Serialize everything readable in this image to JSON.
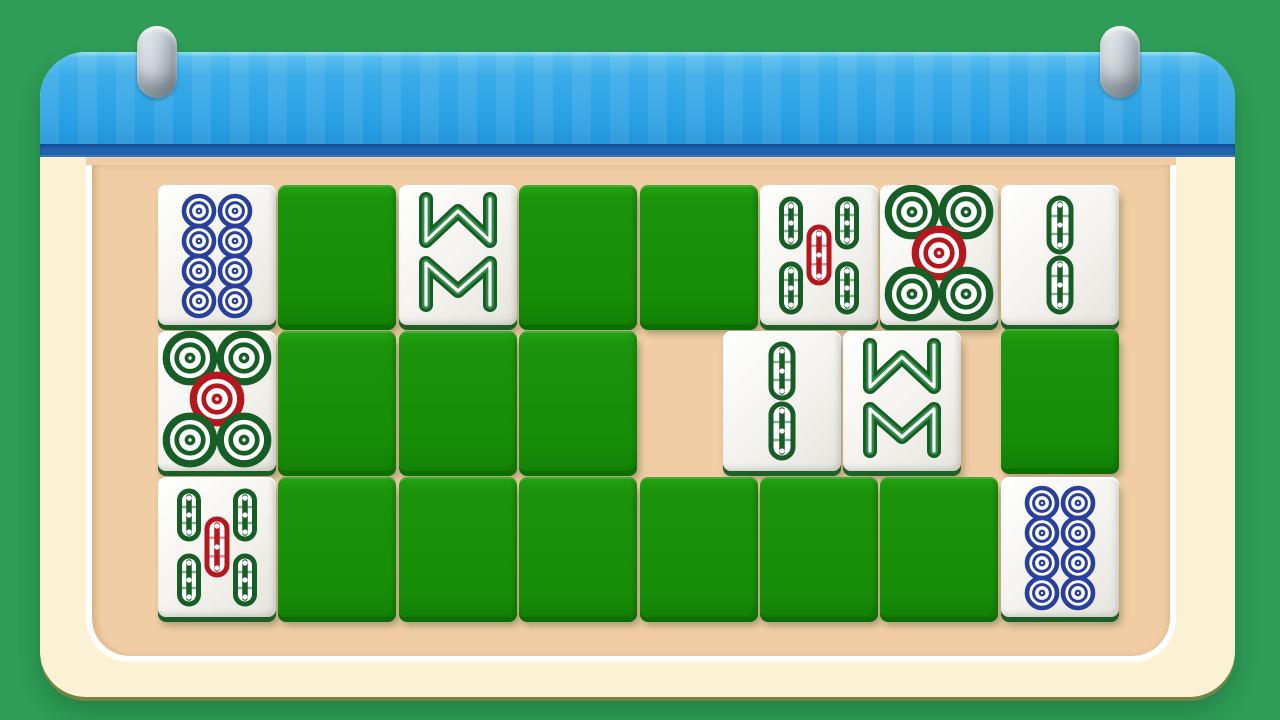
{
  "app": {
    "type": "mahjong-memory-matching-game",
    "scene": "hanging calendar-style board on green table"
  },
  "colors": {
    "background": "#2f9c57",
    "panel": "#fbf2d6",
    "topbar": "#32a5e6",
    "topbar_edge": "#1e62b0",
    "felt": "#f0cda4",
    "tile_down": "#1b930c",
    "tile_down_edge": "#0b6d02",
    "tile_face": "#f3f2ee",
    "tile_face_edge": "#1d5f26",
    "symbol_green": "#175d26",
    "symbol_green_mid": "#2e8b44",
    "symbol_red": "#b5171e",
    "symbol_blue": "#283f9c",
    "hook_metal": "#c9d0d5"
  },
  "board": {
    "rows": 3,
    "cols": 8,
    "face_up_count": 9,
    "face_down_count": 14,
    "empty_count": 1,
    "face_legend": {
      "circles-8": "eight of circles",
      "circles-5": "five of circles",
      "bamboo-8": "eight of bamboo",
      "bamboo-5": "five of bamboo",
      "bamboo-2": "two of bamboo"
    },
    "tiles": [
      {
        "row": 0,
        "col": 0,
        "state": "up",
        "face": "circles-8"
      },
      {
        "row": 0,
        "col": 1,
        "state": "down"
      },
      {
        "row": 0,
        "col": 2,
        "state": "up",
        "face": "bamboo-8"
      },
      {
        "row": 0,
        "col": 3,
        "state": "down"
      },
      {
        "row": 0,
        "col": 4,
        "state": "down"
      },
      {
        "row": 0,
        "col": 5,
        "state": "up",
        "face": "bamboo-5"
      },
      {
        "row": 0,
        "col": 6,
        "state": "up",
        "face": "circles-5"
      },
      {
        "row": 0,
        "col": 7,
        "state": "up",
        "face": "bamboo-2"
      },
      {
        "row": 1,
        "col": 0,
        "state": "up",
        "face": "circles-5"
      },
      {
        "row": 1,
        "col": 1,
        "state": "down"
      },
      {
        "row": 1,
        "col": 2,
        "state": "down"
      },
      {
        "row": 1,
        "col": 3,
        "state": "down"
      },
      {
        "row": 1,
        "col": 4,
        "state": "empty"
      },
      {
        "row": 1,
        "col": 5,
        "state": "up",
        "face": "bamboo-2",
        "dx": -37
      },
      {
        "row": 1,
        "col": 6,
        "state": "up",
        "face": "bamboo-8",
        "dx": -37
      },
      {
        "row": 1,
        "col": 7,
        "state": "down",
        "dy": -2
      },
      {
        "row": 2,
        "col": 0,
        "state": "up",
        "face": "bamboo-5"
      },
      {
        "row": 2,
        "col": 1,
        "state": "down"
      },
      {
        "row": 2,
        "col": 2,
        "state": "down"
      },
      {
        "row": 2,
        "col": 3,
        "state": "down"
      },
      {
        "row": 2,
        "col": 4,
        "state": "down"
      },
      {
        "row": 2,
        "col": 5,
        "state": "down"
      },
      {
        "row": 2,
        "col": 6,
        "state": "down"
      },
      {
        "row": 2,
        "col": 7,
        "state": "up",
        "face": "circles-8"
      }
    ]
  }
}
